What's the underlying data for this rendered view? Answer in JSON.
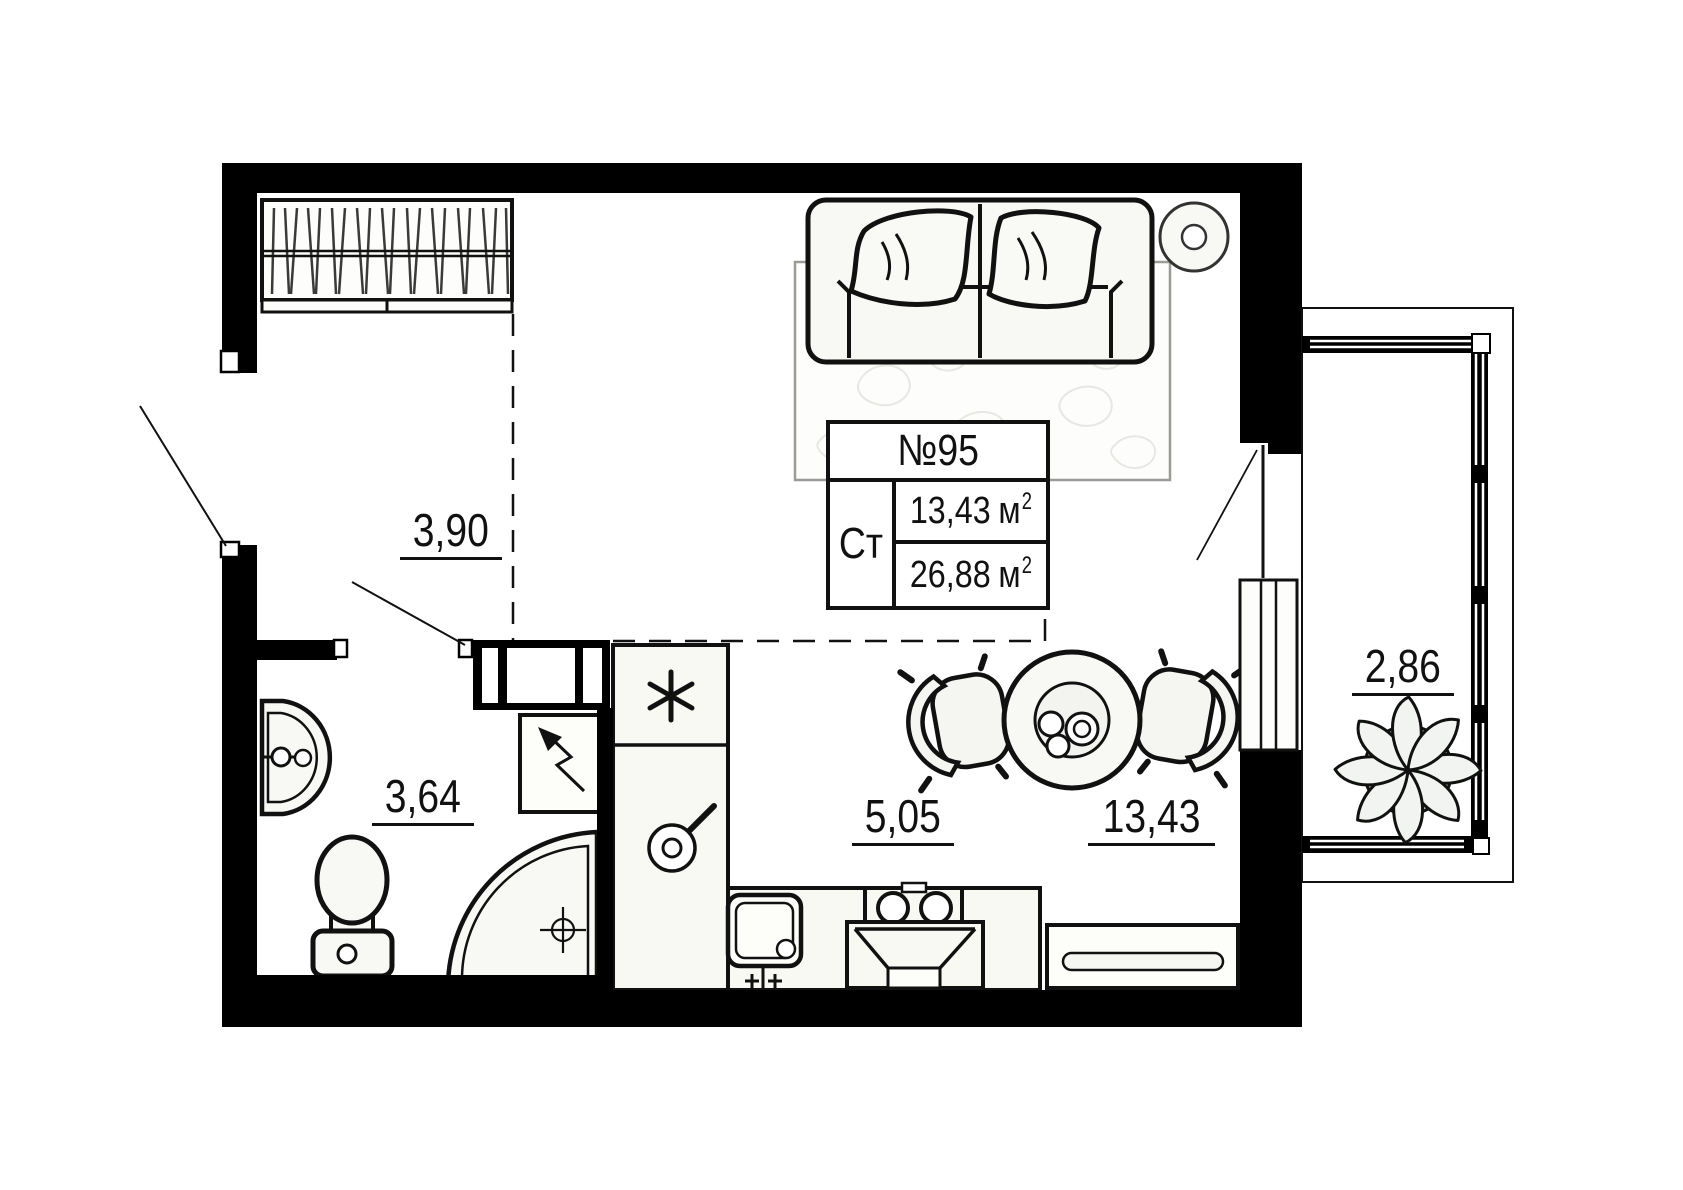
{
  "unit_card": {
    "number": "№95",
    "type_label": "Ст",
    "area_living": "13,43",
    "area_total": "26,88",
    "unit": "м",
    "unit_sup": "2"
  },
  "room_areas": {
    "hallway": "3,90",
    "bathroom": "3,64",
    "kitchen": "5,05",
    "living": "13,43",
    "balcony": "2,86"
  },
  "colors": {
    "walls": "#000000",
    "lines": "#111111",
    "furniture_fill": "#f8f8f5",
    "rug_pattern": "#e7e7e4",
    "plant_pot": "#b5b5b1",
    "background": "#ffffff"
  }
}
